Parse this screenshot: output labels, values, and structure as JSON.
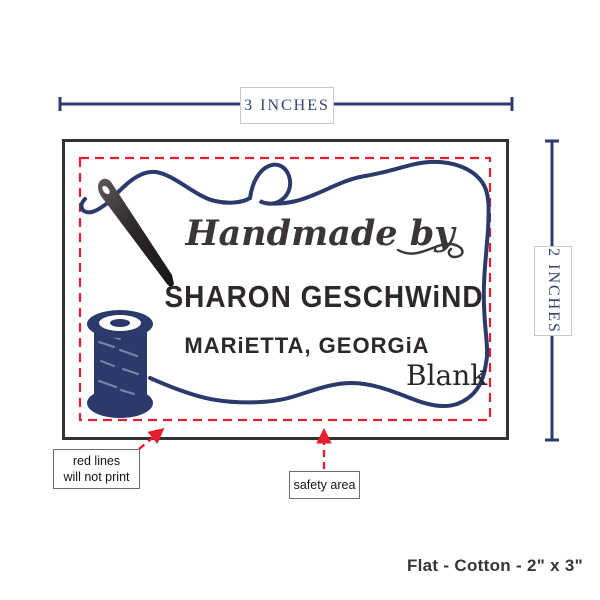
{
  "measurements": {
    "width": "3 INCHES",
    "height": "2 INCHES"
  },
  "label": {
    "handmade_line": "Handmade by",
    "name_line": "SHARON GESCHWiND",
    "location_line": "MARiETTA, GEORGiA",
    "blank_label": "Blank"
  },
  "callouts": {
    "red_lines_line1": "red lines",
    "red_lines_line2": "will not print",
    "safety_area": "safety area"
  },
  "footer": {
    "product_spec": "Flat - Cotton - 2\" x 3\""
  },
  "colors": {
    "navy": "#2b3a6b",
    "red": "#e51f2f",
    "frame": "#333333",
    "ink": "#2d2829"
  },
  "icons": {
    "needle": "needle-icon",
    "spool": "spool-icon",
    "thread": "thread-icon"
  }
}
